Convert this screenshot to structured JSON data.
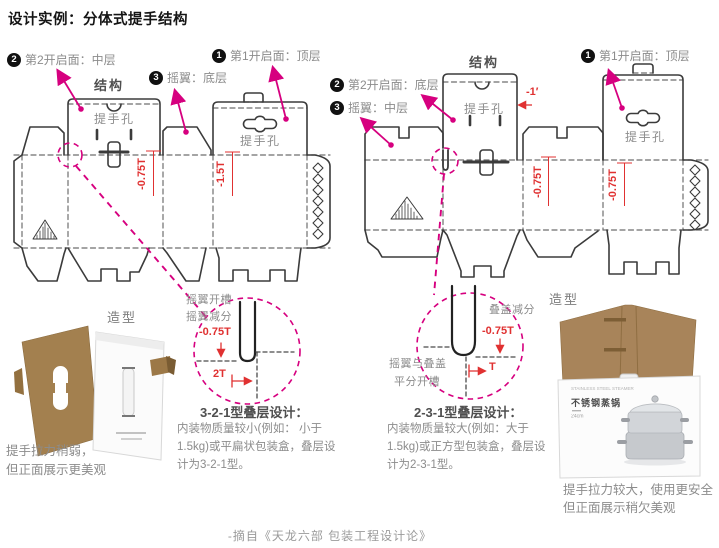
{
  "title": "设计实例：分体式提手结构",
  "left_diagram": {
    "structure_label": "结构",
    "ann2_badge": "2",
    "ann2": "第2开启面：中层",
    "ann3_badge": "3",
    "ann3": "摇翼：底层",
    "ann1_badge": "1",
    "ann1": "第1开启面：顶层",
    "handle_hole_1": "提手孔",
    "handle_hole_2": "提手孔",
    "dim_offset_1": "-0.75T",
    "dim_offset_2": "-1.5T"
  },
  "right_diagram": {
    "structure_label": "结构",
    "ann1_badge": "1",
    "ann1": "第1开启面：顶层",
    "ann2_badge": "2",
    "ann2": "第2开启面：底层",
    "ann3_badge": "3",
    "ann3": "摇翼：中层",
    "handle_hole_1": "提手孔",
    "handle_hole_2": "提手孔",
    "dim_top": "-1′",
    "dim_offset_1": "-0.75T",
    "dim_offset_2": "-0.75T"
  },
  "left_detail": {
    "note_line1": "摇翼开槽",
    "note_line2": "摇翼减分",
    "dim_depth": "-0.75T",
    "dim_width": "2T",
    "heading": "3-2-1型叠层设计：",
    "body": "内装物质量较小(例如： 小于1.5kg)或平扁状包装盒，叠层设计为3-2-1型。"
  },
  "right_detail": {
    "note": "叠盖减分",
    "dim_depth": "-0.75T",
    "dim_width": "T",
    "note2_line1": "摇翼与叠盖",
    "note2_line2": "平分开槽",
    "heading": "2-3-1型叠层设计：",
    "body": "内装物质量较大(例如：大于1.5kg)或正方型包装盒，叠层设计为2-3-1型。"
  },
  "left_photo": {
    "label": "造型",
    "caption_line1": "提手拉力稍弱，",
    "caption_line2": "但正面展示更美观"
  },
  "right_photo": {
    "label": "造型",
    "box_text_en": "STAINLESS STEEL STEAMER",
    "box_text_cn": "不锈钢蒸锅",
    "box_text_size": "24cm",
    "caption_line1": "提手拉力较大，使用更安全",
    "caption_line2": "但正面展示稍欠美观"
  },
  "footer": "-摘自《天龙六部 包装工程设计论》",
  "colors": {
    "accent_pink": "#d6007f",
    "dim_red": "#e03131",
    "text_gray": "#8c8c8c",
    "line_dark": "#3b3b3b"
  }
}
